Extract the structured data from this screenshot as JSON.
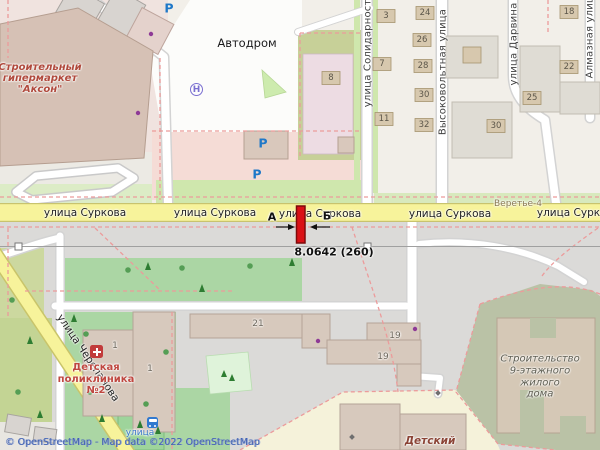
{
  "attribution": "© OpenStreetMap - Map data ©2022 OpenStreetMap",
  "streets": {
    "surkova": "улица Суркова",
    "solidarnosti": "улица Солидарности",
    "vysokovoltnaya": "Высоковольтная улица",
    "darvina": "улица Дарвина",
    "almaznaya": "Алмазная улица",
    "cherepanova": "улица Черепанова",
    "veretye": "Веретье-4"
  },
  "places": {
    "autodrom": "Автодром",
    "akson_lines": [
      "Строительный",
      "гипермаркет",
      "\"Аксон\""
    ],
    "polyclinic_lines": [
      "Детская",
      "поликлиника",
      "№2"
    ],
    "construction_lines": [
      "Строительство",
      "9-этажного",
      "жилого",
      "дома"
    ],
    "kindergarten": "Детский",
    "bus_stop": "улица"
  },
  "icons": {
    "parking": "Р",
    "helipad": "Н"
  },
  "building_numbers": [
    "3",
    "24",
    "26",
    "7",
    "28",
    "30",
    "32",
    "11",
    "8",
    "18",
    "22",
    "25",
    "30"
  ],
  "block_numbers": [
    "21",
    "19",
    "19",
    "1",
    "1"
  ],
  "measurement": {
    "point_a": "А",
    "point_b": "Б",
    "value": "8.0642 (260)"
  },
  "colors": {
    "road_yellow": "#f7f39b",
    "marker_red": "#da1116",
    "park_green": "#abd6a4",
    "pink_landuse": "#f5dcd6",
    "construction_olive": "#bac2a6",
    "attribution_blue": "#4262b1"
  }
}
